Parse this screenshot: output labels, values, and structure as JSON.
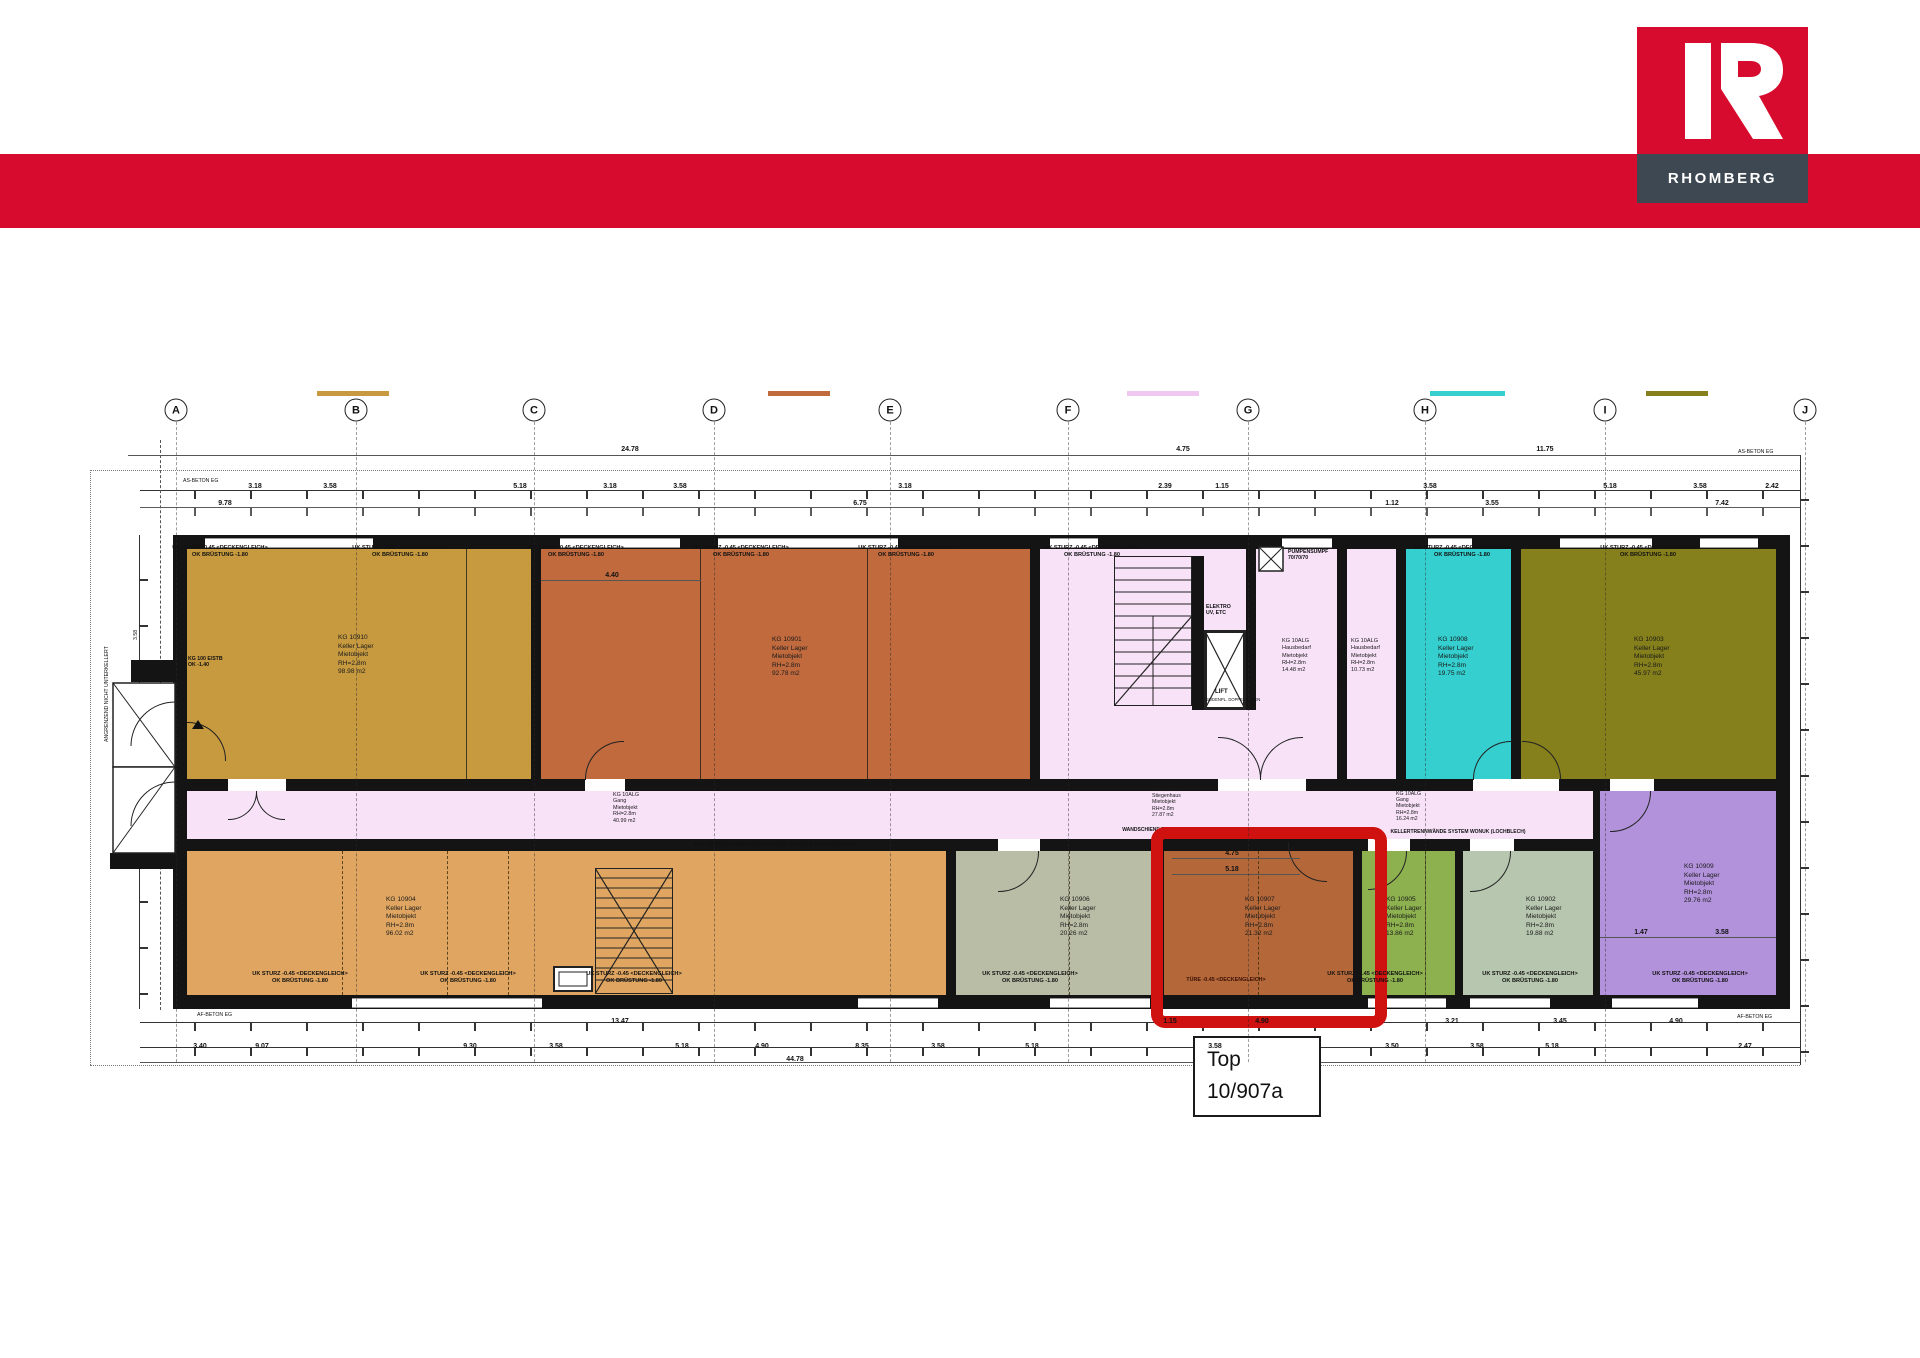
{
  "brand": {
    "name": "RHOMBERG",
    "accent_color": "#d70b2e",
    "bar_color": "#3d4852"
  },
  "callout": {
    "line1": "Top",
    "line2": "10/907a"
  },
  "highlight": {
    "color": "#cf1110"
  },
  "grid_letters": [
    {
      "x": 176,
      "label": "A"
    },
    {
      "x": 356,
      "label": "B"
    },
    {
      "x": 534,
      "label": "C"
    },
    {
      "x": 714,
      "label": "D"
    },
    {
      "x": 890,
      "label": "E"
    },
    {
      "x": 1068,
      "label": "F"
    },
    {
      "x": 1248,
      "label": "G"
    },
    {
      "x": 1425,
      "label": "H"
    },
    {
      "x": 1605,
      "label": "I"
    },
    {
      "x": 1805,
      "label": "J"
    }
  ],
  "legend_swatches": [
    {
      "x": 317,
      "w": 72,
      "color": "#c79a40"
    },
    {
      "x": 768,
      "w": 62,
      "color": "#c06a3e"
    },
    {
      "x": 1127,
      "w": 72,
      "color": "#f0c7ee"
    },
    {
      "x": 1430,
      "w": 75,
      "color": "#35cfcf"
    },
    {
      "x": 1646,
      "w": 62,
      "color": "#85801c"
    }
  ],
  "room_colors": {
    "ochre": "#c79a40",
    "orange": "#c06a3e",
    "pink": "#f8e2f8",
    "cyan": "#35cfcf",
    "olive": "#85801c",
    "tan": "#e0a661",
    "sage": "#b9bda6",
    "highlight_room": "#b4683a",
    "green": "#8db14f",
    "sage2": "#b7c6ae",
    "purple": "#b292da"
  },
  "rooms": {
    "r10910": {
      "label": "KG 10910\nKeller Lager\nMietobjekt\nRH=2.8m\n98.98 m2"
    },
    "r10901": {
      "label": "KG 10901\nKeller Lager\nMietobjekt\nRH=2.8m\n92.78 m2"
    },
    "hausbedarf1": {
      "label": "KG 10ALG\nHausbedarf\nMietobjekt\nRH=2.8m\n14.48 m2"
    },
    "hausbedarf2": {
      "label": "KG 10ALG\nHausbedarf\nMietobjekt\nRH=2.8m\n10.73 m2"
    },
    "r10908": {
      "label": "KG 10908\nKeller Lager\nMietobjekt\nRH=2.8m\n19.75 m2"
    },
    "r10903": {
      "label": "KG 10903\nKeller Lager\nMietobjekt\nRH=2.8m\n45.97 m2"
    },
    "gang": {
      "label": "KG 10ALG\nGang\nMietobjekt\nRH=2.8m\n40.99 m2"
    },
    "stiegenhaus": {
      "label": "KG 10ALG\nStiegenhaus\nMietobjekt\nRH=2.8m\n27.87 m2"
    },
    "gang2": {
      "label": "KG 10ALG\nGang\nMietobjekt\nRH=2.8m\n16.24 m2"
    },
    "r10904": {
      "label": "KG 10904\nKeller Lager\nMietobjekt\nRH=2.8m\n96.02 m2"
    },
    "r10906": {
      "label": "KG 10906\nKeller Lager\nMietobjekt\nRH=2.8m\n20.26 m2"
    },
    "r10907": {
      "label": "KG 10907\nKeller Lager\nMietobjekt\nRH=2.8m\n21.32 m2"
    },
    "r10905": {
      "label": "KG 10905\nKeller Lager\nMietobjekt\nRH=2.8m\n13.86 m2"
    },
    "r10902": {
      "label": "KG 10902\nKeller Lager\nMietobjekt\nRH=2.8m\n19.88 m2"
    },
    "r10909": {
      "label": "KG 10909\nKeller Lager\nMietobjekt\nRH=2.8m\n29.76 m2"
    }
  },
  "plan_texts": {
    "lift": "LIFT",
    "lift_sub": "BODENPL. DOPPELBODEN",
    "elektro": "ELEKTRO\nUV, ETC",
    "pumpensumpf": "PUMPENSUMPF\n70/70/70",
    "lichtschacht": "LICHTSCHACHT",
    "trennwand": "KELLERTRENNWÄNDE SYSTEM WONUK (LOCHBLECH)",
    "wandschiene": "WANDSCHIENE F. 60 LICHTPROFILE",
    "uk_sturz": "UK STURZ -0.45 <DECKENGLEICH>\nOK BRÜSTUNG -1.80",
    "tuere": "TÜRE -0.45 <DECKENGLEICH>",
    "beton_top_left": "AS-BETON EG",
    "beton_top_right": "AS-BETON EG",
    "beton_bottom_left": "AF-BETON EG",
    "beton_bottom_right": "AF-BETON EG",
    "estb": "KG 100 E/STB\nOK -1.40",
    "angrenzend": "ANGRENZEND NICHT UNTERKELLERT",
    "dim_left_a": "3.58",
    "dim_left_b": "6.75"
  },
  "wall_notes_top": [
    {
      "x": 220
    },
    {
      "x": 400
    },
    {
      "x": 576
    },
    {
      "x": 741
    },
    {
      "x": 906
    },
    {
      "x": 1092
    },
    {
      "x": 1462
    },
    {
      "x": 1648
    }
  ],
  "wall_notes_bottom": [
    {
      "x": 300
    },
    {
      "x": 468
    },
    {
      "x": 634
    },
    {
      "x": 1030
    },
    {
      "x": 1375
    },
    {
      "x": 1530
    },
    {
      "x": 1700
    }
  ],
  "dim_labels": [
    {
      "x": 630,
      "y": 446,
      "t": "24.78"
    },
    {
      "x": 1183,
      "y": 446,
      "t": "4.75"
    },
    {
      "x": 1545,
      "y": 446,
      "t": "11.75"
    },
    {
      "x": 255,
      "y": 483,
      "t": "3.18"
    },
    {
      "x": 330,
      "y": 483,
      "t": "3.58"
    },
    {
      "x": 520,
      "y": 483,
      "t": "5.18"
    },
    {
      "x": 610,
      "y": 483,
      "t": "3.18"
    },
    {
      "x": 680,
      "y": 483,
      "t": "3.58"
    },
    {
      "x": 905,
      "y": 483,
      "t": "3.18"
    },
    {
      "x": 1165,
      "y": 483,
      "t": "2.39"
    },
    {
      "x": 1222,
      "y": 483,
      "t": "1.15"
    },
    {
      "x": 1430,
      "y": 483,
      "t": "3.58"
    },
    {
      "x": 1610,
      "y": 483,
      "t": "5.18"
    },
    {
      "x": 1700,
      "y": 483,
      "t": "3.58"
    },
    {
      "x": 1772,
      "y": 483,
      "t": "2.42"
    },
    {
      "x": 225,
      "y": 500,
      "t": "9.78"
    },
    {
      "x": 860,
      "y": 500,
      "t": "6.75"
    },
    {
      "x": 1392,
      "y": 500,
      "t": "1.12"
    },
    {
      "x": 1492,
      "y": 500,
      "t": "3.55"
    },
    {
      "x": 1722,
      "y": 500,
      "t": "7.42"
    },
    {
      "x": 612,
      "y": 572,
      "t": "4.40"
    },
    {
      "x": 1232,
      "y": 850,
      "t": "4.75"
    },
    {
      "x": 1232,
      "y": 866,
      "t": "5.18"
    },
    {
      "x": 1641,
      "y": 929,
      "t": "1.47"
    },
    {
      "x": 1722,
      "y": 929,
      "t": "3.58"
    },
    {
      "x": 620,
      "y": 1018,
      "t": "13.47"
    },
    {
      "x": 1170,
      "y": 1018,
      "t": "1.15"
    },
    {
      "x": 1262,
      "y": 1018,
      "t": "4.90"
    },
    {
      "x": 1452,
      "y": 1018,
      "t": "3.21"
    },
    {
      "x": 1560,
      "y": 1018,
      "t": "3.45"
    },
    {
      "x": 1676,
      "y": 1018,
      "t": "4.90"
    },
    {
      "x": 200,
      "y": 1043,
      "t": "3.40"
    },
    {
      "x": 262,
      "y": 1043,
      "t": "9.07"
    },
    {
      "x": 470,
      "y": 1043,
      "t": "9.30"
    },
    {
      "x": 556,
      "y": 1043,
      "t": "3.58"
    },
    {
      "x": 682,
      "y": 1043,
      "t": "5.18"
    },
    {
      "x": 762,
      "y": 1043,
      "t": "4.90"
    },
    {
      "x": 862,
      "y": 1043,
      "t": "8.35"
    },
    {
      "x": 938,
      "y": 1043,
      "t": "3.58"
    },
    {
      "x": 1032,
      "y": 1043,
      "t": "5.18"
    },
    {
      "x": 1215,
      "y": 1043,
      "t": "3.58"
    },
    {
      "x": 1392,
      "y": 1043,
      "t": "3.50"
    },
    {
      "x": 1477,
      "y": 1043,
      "t": "3.58"
    },
    {
      "x": 1552,
      "y": 1043,
      "t": "5.18"
    },
    {
      "x": 1745,
      "y": 1043,
      "t": "2.47"
    },
    {
      "x": 795,
      "y": 1056,
      "t": "44.78"
    }
  ]
}
